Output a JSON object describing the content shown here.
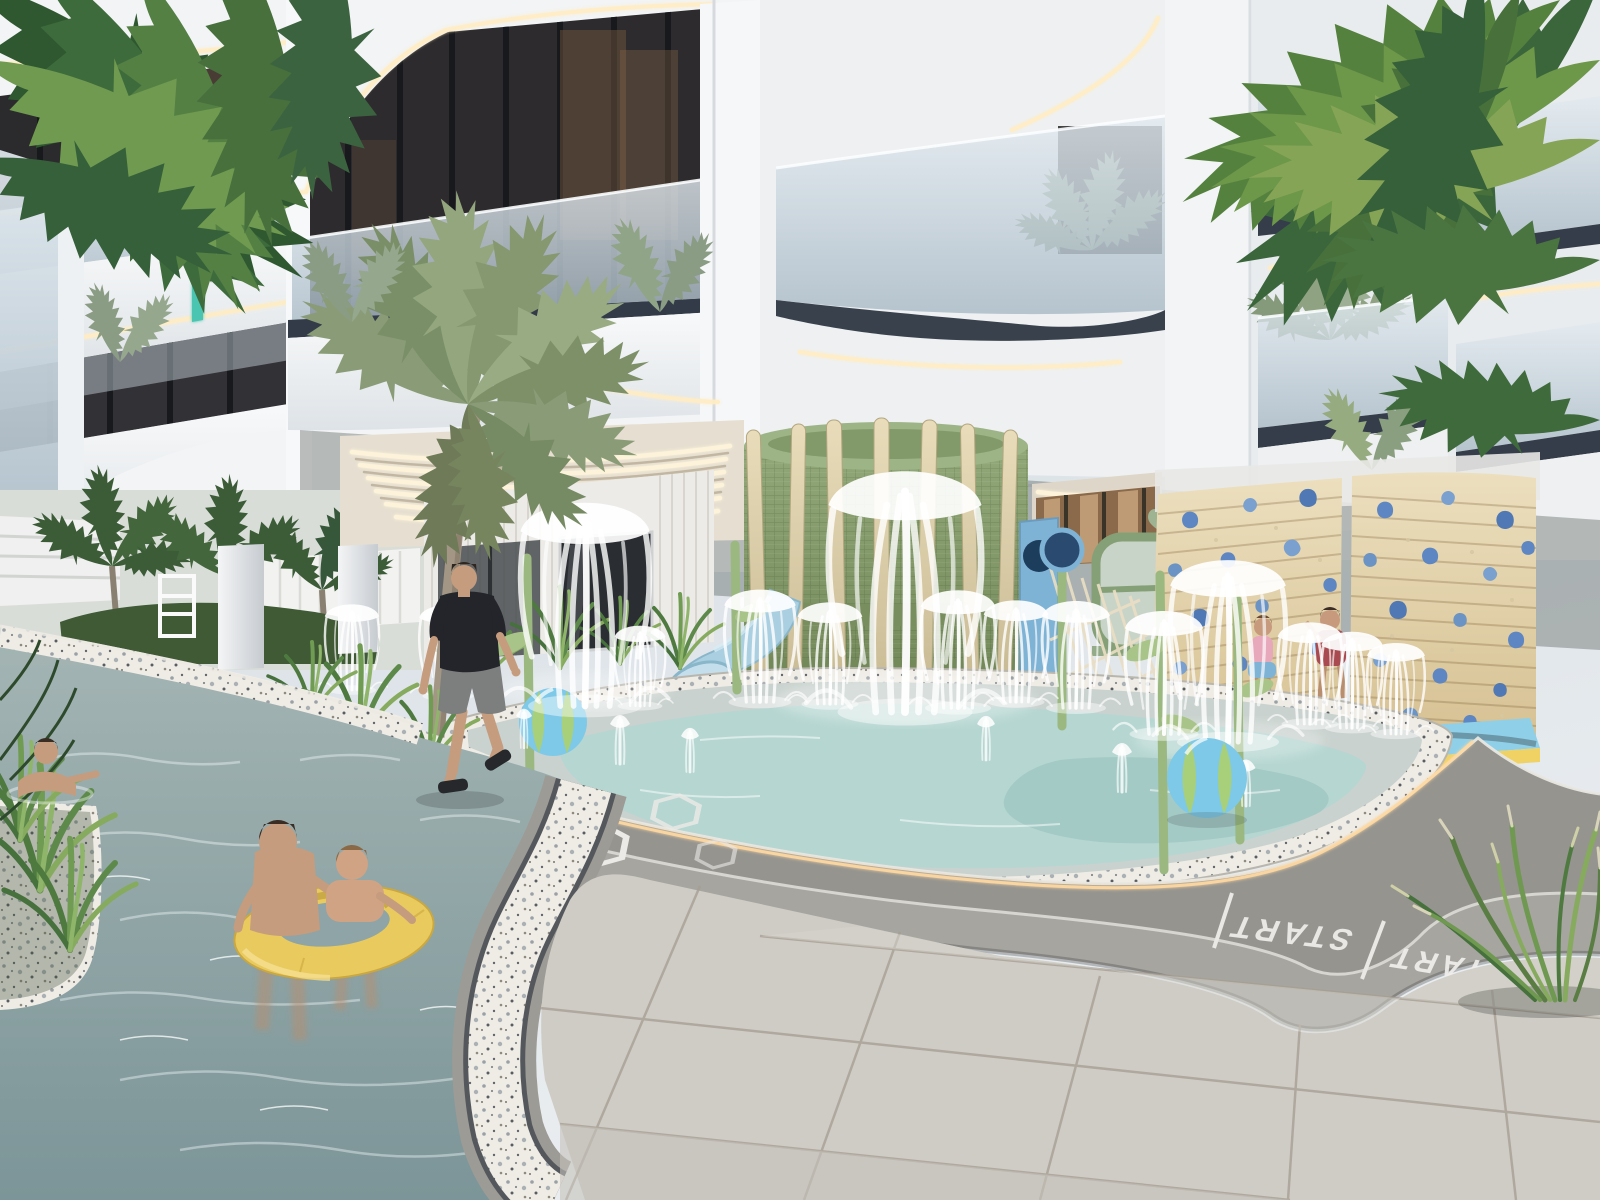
{
  "scene": {
    "type": "3d-architectural-render",
    "subject": "Residential tower amenity courtyard with children's splash pad, lazy river and jogging track",
    "time_of_day": "day",
    "camera": "street-level corner view looking up at curved balconies"
  },
  "building": {
    "style": "curved contemporary balconies with glass railings",
    "facade_color": "#f2f4f5",
    "trim_color": "#323b47",
    "glass_color": "#b6c3cc",
    "cove_light_color": "#ffedc4",
    "accent_light_color": "#49c5b2",
    "balcony_plants": "potted palms"
  },
  "amenities": {
    "splash_pad": {
      "water_color": "#b5d6d1",
      "deck_color": "#c9d2ce",
      "border": "terrazzo",
      "fountain_count": 14,
      "stem_sprinkler_color": "#9ab87f",
      "beach_ball_colors": [
        "#7ec9e8",
        "#a8cf7a"
      ]
    },
    "green_tower": {
      "mesh_color": "#849b66",
      "slat_color": "#e0d3b0"
    },
    "water_slide": {
      "color": "#a9cfe1"
    },
    "playground": {
      "frame_color": "#85a077",
      "net_color": "#e9dec4",
      "panel_color": "#7fb3d6",
      "decor": "sage hearts"
    },
    "climbing_wall": {
      "panel_material": "wood planks",
      "panel_color": "#e8d8b4",
      "hold_color": "#5d86c2",
      "mat_colors": [
        "#8fd0e8",
        "#efd263"
      ]
    },
    "jogging_track": {
      "surface_color": "#a6a5a0",
      "lane_line_color": "#e8e7e2",
      "curb_light_color": "#ffd9a2",
      "lanes": 2,
      "lane_markings": "hexagon outlines",
      "start_labels": [
        "START",
        "START"
      ]
    },
    "lazy_river": {
      "water_color": "#8ea4a6",
      "edge": "terrazzo",
      "float_ring_color": "#e9ca5e"
    }
  },
  "people": [
    {
      "name": "swimmer",
      "location": "lazy river far left"
    },
    {
      "name": "man and boy on yellow float ring",
      "location": "lazy river foreground"
    },
    {
      "name": "walking man",
      "shirt_color": "#23252a",
      "shorts_color": "#7d7f7e",
      "location": "jogging track"
    },
    {
      "name": "child in pink",
      "location": "splash pad near climbing wall"
    },
    {
      "name": "child in red",
      "location": "splash pad near climbing wall"
    }
  ],
  "vegetation": {
    "palms": "coconut palms overhanging from top corners plus courtyard palms",
    "grasses": "ornamental grasses along river, median and track edge"
  },
  "palette": {
    "sky": "#ccd5dc",
    "tile": "#cfccc6",
    "tile_joint": "#a59d91",
    "terrazzo": "#efece6",
    "soffit_light": "#fdf3da",
    "river_water": "#8ea4a6"
  }
}
